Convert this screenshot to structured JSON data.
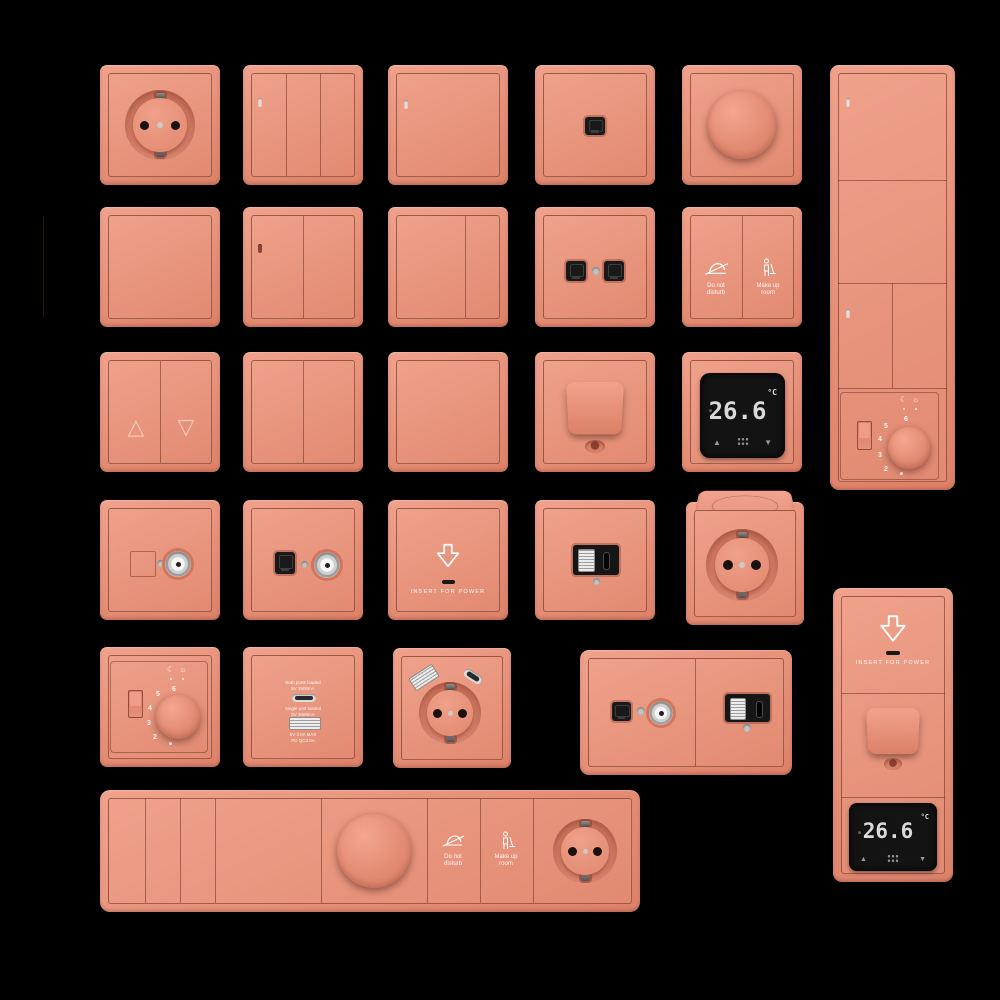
{
  "palette": {
    "background": "#000000",
    "plate": "#e8937d",
    "line": "#6b2d1e",
    "display": "#131313",
    "accent_white": "#ffffff"
  },
  "icons": {
    "moon": "☾",
    "sun": "☼",
    "triangle_up": "△",
    "triangle_down": "▽",
    "arrow_up": "▲",
    "arrow_down": "▼"
  },
  "labels": {
    "do_not_disturb": [
      "Do not",
      "disturb"
    ],
    "make_up_room": [
      "Make up",
      "room"
    ],
    "insert_for_power": "INSERT FOR POWER",
    "thermostat": {
      "value": "26.6",
      "unit": "°C"
    },
    "dial_numbers": [
      "6",
      "5",
      "4",
      "3",
      "2"
    ],
    "usb_charger": [
      "Both ports loaded",
      "5V 1500mA",
      "Single port loaded",
      "5V 3000mA",
      "5V 3.0A MAX",
      "PD QC3.0A"
    ]
  },
  "devices": [
    "schuko-socket",
    "switch-3-gang",
    "switch-1-gang",
    "data-outlet-single",
    "rotary-dimmer",
    "multi-panel-switches-thermostat-dial",
    "switch-1-gang-plain",
    "switch-2-gang",
    "switch-3-gang",
    "data-outlet-double",
    "room-service-switch",
    "blinds-switch",
    "switch-2-gang",
    "switch-1-gang",
    "toggle-lever-switch",
    "digital-thermostat",
    "tv-coax-outlet",
    "tv-data-outlet",
    "key-card-holder",
    "usb-outlet",
    "schuko-socket-with-lid",
    "thermostat-dial",
    "usb-charger",
    "schuko-socket-usb",
    "tv-data-usb-combo",
    "key-card-toggle-thermostat-panel",
    "multi-function-horizontal-panel"
  ]
}
